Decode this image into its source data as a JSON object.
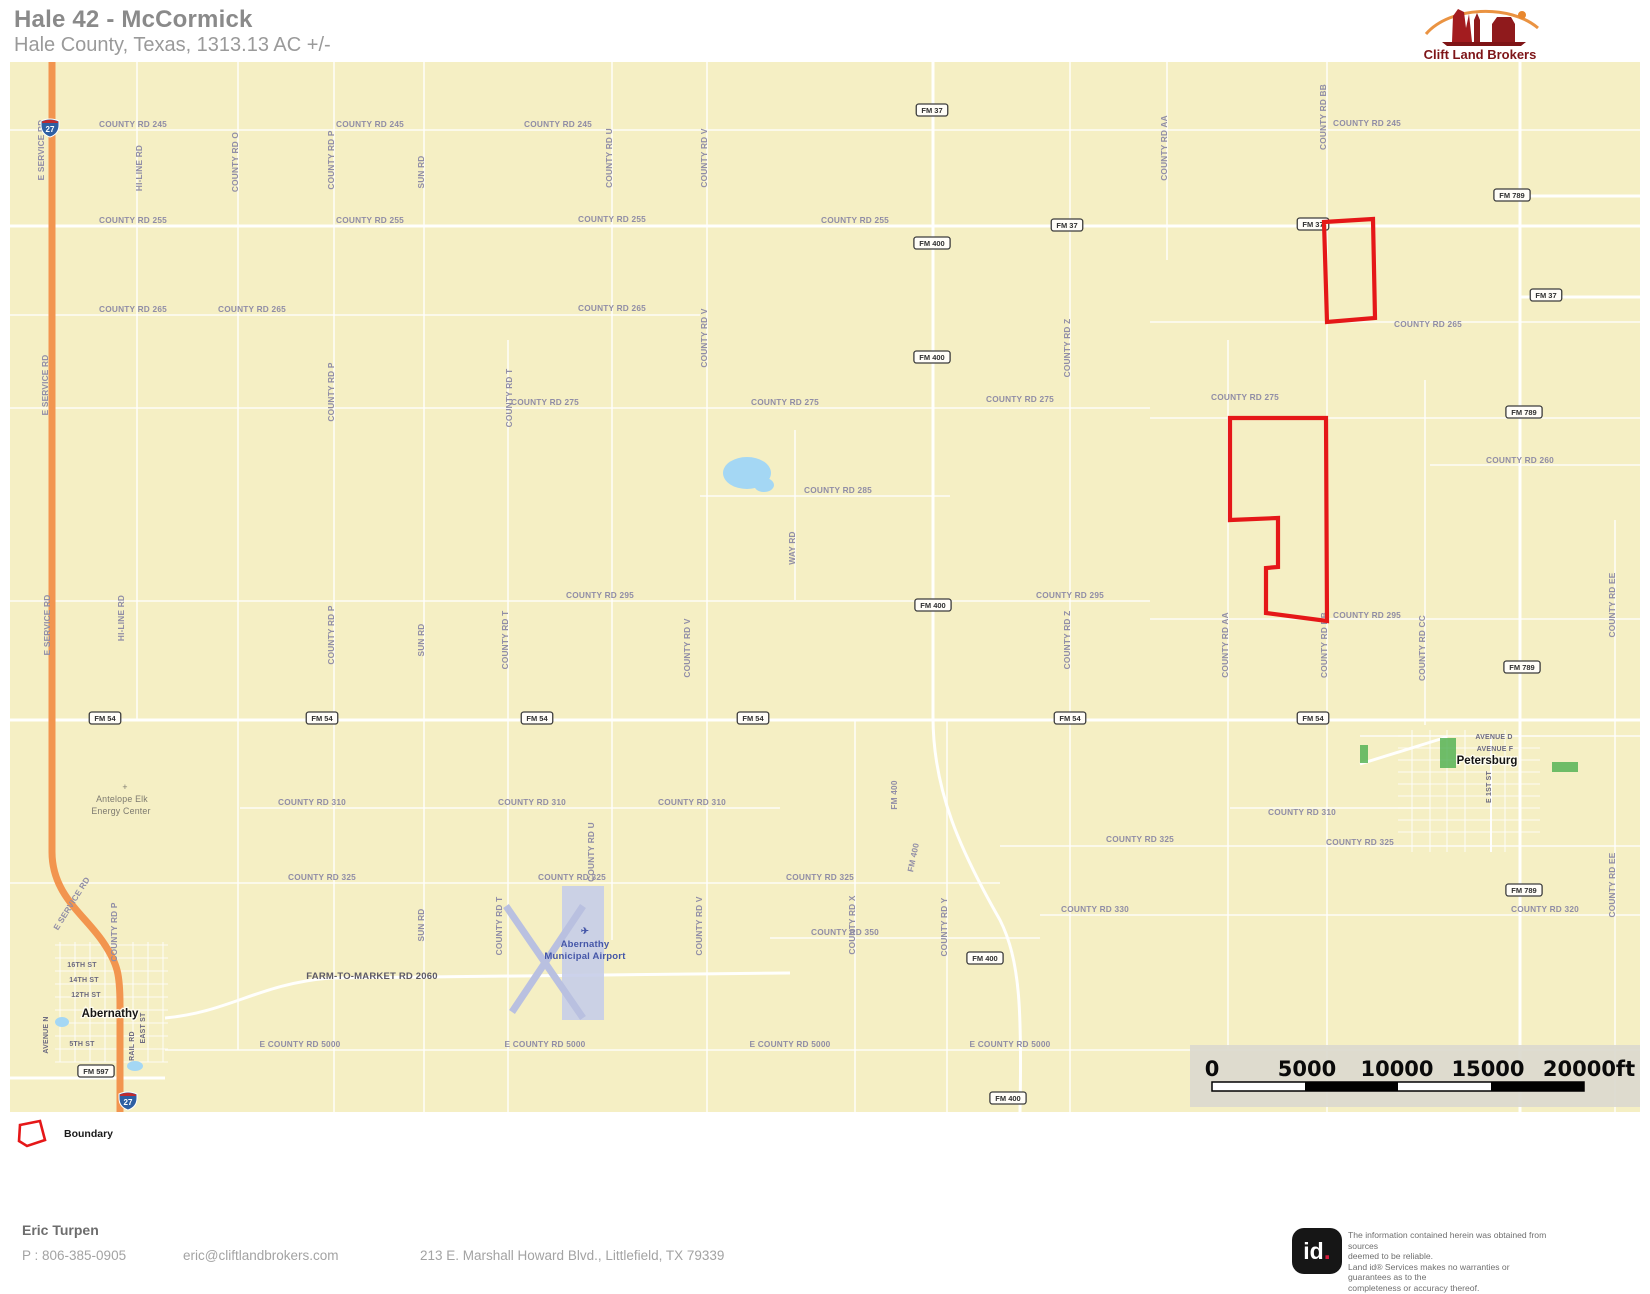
{
  "header": {
    "title": "Hale 42 - McCormick",
    "subtitle": "Hale County, Texas, 1313.13 AC +/-"
  },
  "brand": {
    "name": "Clift Land Brokers"
  },
  "map": {
    "colors": {
      "background": "#F5EFC4",
      "boundary": "#E51718",
      "highway": "#F2954F",
      "water": "#A4D7F4",
      "park": "#4CAF50",
      "label": "#908DA6"
    },
    "labels": [
      {
        "t": "COUNTY RD 245",
        "x": 133,
        "y": 127
      },
      {
        "t": "COUNTY RD 245",
        "x": 370,
        "y": 127
      },
      {
        "t": "COUNTY RD 245",
        "x": 558,
        "y": 127
      },
      {
        "t": "COUNTY RD 245",
        "x": 1367,
        "y": 126
      },
      {
        "t": "COUNTY RD 255",
        "x": 133,
        "y": 223
      },
      {
        "t": "COUNTY RD 255",
        "x": 370,
        "y": 223
      },
      {
        "t": "COUNTY RD 255",
        "x": 612,
        "y": 222
      },
      {
        "t": "COUNTY RD 255",
        "x": 855,
        "y": 223
      },
      {
        "t": "COUNTY RD 265",
        "x": 133,
        "y": 312
      },
      {
        "t": "COUNTY RD 265",
        "x": 252,
        "y": 312
      },
      {
        "t": "COUNTY RD 265",
        "x": 612,
        "y": 311
      },
      {
        "t": "COUNTY RD 265",
        "x": 1428,
        "y": 327
      },
      {
        "t": "COUNTY RD 275",
        "x": 545,
        "y": 405
      },
      {
        "t": "COUNTY RD 275",
        "x": 785,
        "y": 405
      },
      {
        "t": "COUNTY RD 275",
        "x": 1020,
        "y": 402
      },
      {
        "t": "COUNTY RD 275",
        "x": 1245,
        "y": 400
      },
      {
        "t": "COUNTY RD 285",
        "x": 838,
        "y": 493
      },
      {
        "t": "COUNTY RD 295",
        "x": 600,
        "y": 598
      },
      {
        "t": "COUNTY RD 295",
        "x": 1070,
        "y": 598
      },
      {
        "t": "COUNTY RD 295",
        "x": 1367,
        "y": 618
      },
      {
        "t": "COUNTY RD 260",
        "x": 1520,
        "y": 463
      },
      {
        "t": "COUNTY RD 310",
        "x": 312,
        "y": 805
      },
      {
        "t": "COUNTY RD 310",
        "x": 532,
        "y": 805
      },
      {
        "t": "COUNTY RD 310",
        "x": 692,
        "y": 805
      },
      {
        "t": "COUNTY RD 310",
        "x": 1302,
        "y": 815
      },
      {
        "t": "COUNTY RD 325",
        "x": 322,
        "y": 880
      },
      {
        "t": "COUNTY RD 325",
        "x": 572,
        "y": 880
      },
      {
        "t": "COUNTY RD 325",
        "x": 820,
        "y": 880
      },
      {
        "t": "COUNTY RD 325",
        "x": 1140,
        "y": 842
      },
      {
        "t": "COUNTY RD 325",
        "x": 1360,
        "y": 845
      },
      {
        "t": "COUNTY RD 330",
        "x": 1095,
        "y": 912
      },
      {
        "t": "COUNTY RD 320",
        "x": 1545,
        "y": 912
      },
      {
        "t": "COUNTY RD 350",
        "x": 845,
        "y": 935
      },
      {
        "t": "E COUNTY RD 5000",
        "x": 300,
        "y": 1047
      },
      {
        "t": "E COUNTY RD 5000",
        "x": 545,
        "y": 1047
      },
      {
        "t": "E COUNTY RD 5000",
        "x": 790,
        "y": 1047
      },
      {
        "t": "E COUNTY RD 5000",
        "x": 1010,
        "y": 1047
      },
      {
        "t": "FARM-TO-MARKET RD 2060",
        "x": 372,
        "y": 979,
        "c": "big"
      },
      {
        "t": "16TH ST",
        "x": 82,
        "y": 967,
        "c": "st"
      },
      {
        "t": "14TH ST",
        "x": 84,
        "y": 982,
        "c": "st"
      },
      {
        "t": "12TH ST",
        "x": 86,
        "y": 997,
        "c": "st"
      },
      {
        "t": "5TH ST",
        "x": 82,
        "y": 1046,
        "c": "st"
      },
      {
        "t": "AVENUE D",
        "x": 1494,
        "y": 739,
        "c": "st"
      },
      {
        "t": "AVENUE F",
        "x": 1495,
        "y": 751,
        "c": "st"
      },
      {
        "t": "E SERVICE RD",
        "x": 44,
        "y": 150,
        "r": -90
      },
      {
        "t": "E SERVICE RD",
        "x": 48,
        "y": 385,
        "r": -90
      },
      {
        "t": "E SERVICE RD",
        "x": 50,
        "y": 625,
        "r": -90
      },
      {
        "t": "E SERVICE RD",
        "x": 74,
        "y": 905,
        "r": -58
      },
      {
        "t": "HI-LINE RD",
        "x": 142,
        "y": 168,
        "r": -90
      },
      {
        "t": "HI-LINE RD",
        "x": 124,
        "y": 618,
        "r": -90
      },
      {
        "t": "COUNTY RD O",
        "x": 238,
        "y": 162,
        "r": -90
      },
      {
        "t": "COUNTY RD P",
        "x": 334,
        "y": 160,
        "r": -90
      },
      {
        "t": "COUNTY RD P",
        "x": 334,
        "y": 392,
        "r": -90
      },
      {
        "t": "COUNTY RD P",
        "x": 334,
        "y": 635,
        "r": -90
      },
      {
        "t": "COUNTY RD P",
        "x": 117,
        "y": 932,
        "r": -90
      },
      {
        "t": "SUN RD",
        "x": 424,
        "y": 172,
        "r": -90
      },
      {
        "t": "SUN RD",
        "x": 424,
        "y": 640,
        "r": -90
      },
      {
        "t": "SUN RD",
        "x": 424,
        "y": 925,
        "r": -90
      },
      {
        "t": "COUNTY RD T",
        "x": 512,
        "y": 398,
        "r": -90
      },
      {
        "t": "COUNTY RD T",
        "x": 508,
        "y": 640,
        "r": -90
      },
      {
        "t": "COUNTY RD T",
        "x": 502,
        "y": 926,
        "r": -90
      },
      {
        "t": "COUNTY RD U",
        "x": 612,
        "y": 158,
        "r": -90
      },
      {
        "t": "COUNTY RD U",
        "x": 594,
        "y": 852,
        "r": -90
      },
      {
        "t": "COUNTY RD V",
        "x": 707,
        "y": 158,
        "r": -90
      },
      {
        "t": "COUNTY RD V",
        "x": 707,
        "y": 338,
        "r": -90
      },
      {
        "t": "COUNTY RD V",
        "x": 690,
        "y": 648,
        "r": -90
      },
      {
        "t": "COUNTY RD V",
        "x": 702,
        "y": 926,
        "r": -90
      },
      {
        "t": "WAY RD",
        "x": 795,
        "y": 548,
        "r": -90
      },
      {
        "t": "COUNTY RD X",
        "x": 855,
        "y": 925,
        "r": -90
      },
      {
        "t": "COUNTY RD Y",
        "x": 947,
        "y": 927,
        "r": -90
      },
      {
        "t": "COUNTY RD Z",
        "x": 1070,
        "y": 348,
        "r": -90
      },
      {
        "t": "COUNTY RD Z",
        "x": 1070,
        "y": 640,
        "r": -90
      },
      {
        "t": "COUNTY RD AA",
        "x": 1167,
        "y": 148,
        "r": -90
      },
      {
        "t": "COUNTY RD AA",
        "x": 1228,
        "y": 645,
        "r": -90
      },
      {
        "t": "COUNTY RD BB",
        "x": 1326,
        "y": 117,
        "r": -90
      },
      {
        "t": "COUNTY RD BB",
        "x": 1327,
        "y": 645,
        "r": -90
      },
      {
        "t": "COUNTY RD CC",
        "x": 1425,
        "y": 648,
        "r": -90
      },
      {
        "t": "COUNTY RD EE",
        "x": 1615,
        "y": 605,
        "r": -90
      },
      {
        "t": "COUNTY RD EE",
        "x": 1615,
        "y": 885,
        "r": -90
      },
      {
        "t": "FM 400",
        "x": 897,
        "y": 795,
        "r": -90
      },
      {
        "t": "FM 400",
        "x": 916,
        "y": 858,
        "r": -78
      },
      {
        "t": "E 1ST ST",
        "x": 1491,
        "y": 787,
        "r": -90,
        "c": "st"
      },
      {
        "t": "AVENUE N",
        "x": 48,
        "y": 1035,
        "r": -90,
        "c": "st"
      },
      {
        "t": "EAST ST",
        "x": 145,
        "y": 1028,
        "r": -90,
        "c": "st"
      },
      {
        "t": "RAIL RD",
        "x": 134,
        "y": 1046,
        "r": -90,
        "c": "st"
      },
      {
        "t": "Antelope Elk",
        "x": 122,
        "y": 802,
        "c": "poi"
      },
      {
        "t": "Energy Center",
        "x": 121,
        "y": 814,
        "c": "poi"
      },
      {
        "t": "+",
        "x": 125,
        "y": 790,
        "c": "poi"
      },
      {
        "t": "✈",
        "x": 585,
        "y": 934,
        "c": "blue"
      },
      {
        "t": "Abernathy",
        "x": 585,
        "y": 947,
        "c": "blue"
      },
      {
        "t": "Municipal Airport",
        "x": 585,
        "y": 959,
        "c": "blue"
      }
    ],
    "shields": [
      {
        "t": "FM 37",
        "x": 932,
        "y": 110
      },
      {
        "t": "FM 37",
        "x": 1067,
        "y": 225
      },
      {
        "t": "FM 37",
        "x": 1313,
        "y": 224
      },
      {
        "t": "FM 37",
        "x": 1546,
        "y": 295
      },
      {
        "t": "FM 400",
        "x": 932,
        "y": 243
      },
      {
        "t": "FM 400",
        "x": 932,
        "y": 357
      },
      {
        "t": "FM 400",
        "x": 933,
        "y": 605
      },
      {
        "t": "FM 400",
        "x": 985,
        "y": 958
      },
      {
        "t": "FM 400",
        "x": 1008,
        "y": 1098
      },
      {
        "t": "FM 789",
        "x": 1512,
        "y": 195
      },
      {
        "t": "FM 789",
        "x": 1524,
        "y": 412
      },
      {
        "t": "FM 789",
        "x": 1522,
        "y": 667
      },
      {
        "t": "FM 789",
        "x": 1524,
        "y": 890
      },
      {
        "t": "FM 54",
        "x": 105,
        "y": 718
      },
      {
        "t": "FM 54",
        "x": 322,
        "y": 718
      },
      {
        "t": "FM 54",
        "x": 537,
        "y": 718
      },
      {
        "t": "FM 54",
        "x": 753,
        "y": 718
      },
      {
        "t": "FM 54",
        "x": 1070,
        "y": 718
      },
      {
        "t": "FM 54",
        "x": 1313,
        "y": 718
      },
      {
        "t": "FM 597",
        "x": 96,
        "y": 1071
      }
    ],
    "interstate_shields": [
      {
        "t": "27",
        "x": 50,
        "y": 127
      },
      {
        "t": "27",
        "x": 128,
        "y": 1100
      }
    ],
    "towns": [
      {
        "t": "Abernathy",
        "x": 110,
        "y": 1017
      },
      {
        "t": "Petersburg",
        "x": 1487,
        "y": 764
      }
    ],
    "parcels": [
      {
        "name": "parcel-north",
        "points": "1324,222 1373,219 1375,318 1327,322"
      },
      {
        "name": "parcel-south",
        "points": "1230,418 1326,418 1327,621 1266,613 1266,568 1278,567 1278,518 1230,520"
      }
    ],
    "legend": {
      "label": "Boundary"
    },
    "scalebar": {
      "labels": [
        "0",
        "5000",
        "10000",
        "15000",
        "20000ft"
      ]
    }
  },
  "footer": {
    "name": "Eric Turpen",
    "phone": "P : 806-385-0905",
    "email": "eric@cliftlandbrokers.com",
    "address": "213 E. Marshall Howard Blvd., Littlefield, TX 79339"
  },
  "disclaimer": {
    "logo_text": "id",
    "lines": [
      "The information contained herein was obtained from sources",
      "deemed to be reliable.",
      " Land id® Services makes no warranties or guarantees as to the",
      "completeness or accuracy thereof."
    ]
  }
}
